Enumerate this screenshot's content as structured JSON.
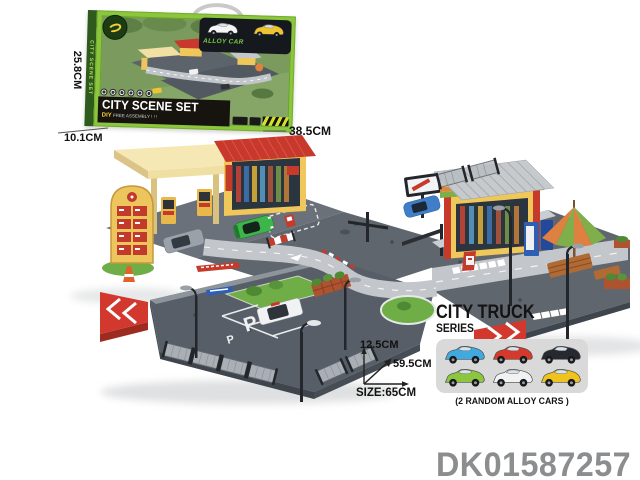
{
  "product_code": "DK01587257",
  "box": {
    "spine_text": "CITY SCENE SET",
    "title": "CITY SCENE SET",
    "subtitle_diy": "DIY",
    "subtitle_rest": "FREE ASSEMBLY ! ! !",
    "alloy_label": "ALLOY CAR",
    "dim_height": "25.8CM",
    "dim_depth": "10.1CM",
    "dim_width": "38.5CM",
    "window_cars": [
      {
        "name": "white",
        "color": "#f4f4f4"
      },
      {
        "name": "yellow",
        "color": "#eec431"
      }
    ]
  },
  "size_diagram": {
    "height_label": "12.5CM",
    "depth_label": "59.5CM",
    "width_label": "SIZE:65CM"
  },
  "series_card": {
    "title": "CITY TRUCK",
    "subtitle": "SERIES",
    "note": "(2 RANDOM ALLOY CARS )",
    "cars": [
      {
        "name": "blue",
        "color": "#3fa9e0"
      },
      {
        "name": "red",
        "color": "#d6392c"
      },
      {
        "name": "black",
        "color": "#262a30"
      },
      {
        "name": "green",
        "color": "#8cc63f"
      },
      {
        "name": "white",
        "color": "#f2f2f2"
      },
      {
        "name": "yellow",
        "color": "#efc31c"
      }
    ]
  },
  "playset": {
    "parking_letter": "P",
    "colors": {
      "plate": "#5f666e",
      "road": "#c3c7cc",
      "canopy": "#f0dfa3",
      "roof_red": "#c8382c",
      "wall_yellow": "#f0c75a",
      "roof_gray": "#c6cacd",
      "grass": "#6fae46",
      "ramp_red": "#d2382d",
      "umbrella_orange": "#dd8040",
      "umbrella_green": "#7fae4a",
      "bench_brown": "#b06a33",
      "car_green": "#3db54a",
      "car_blue": "#3f7fc9"
    }
  }
}
